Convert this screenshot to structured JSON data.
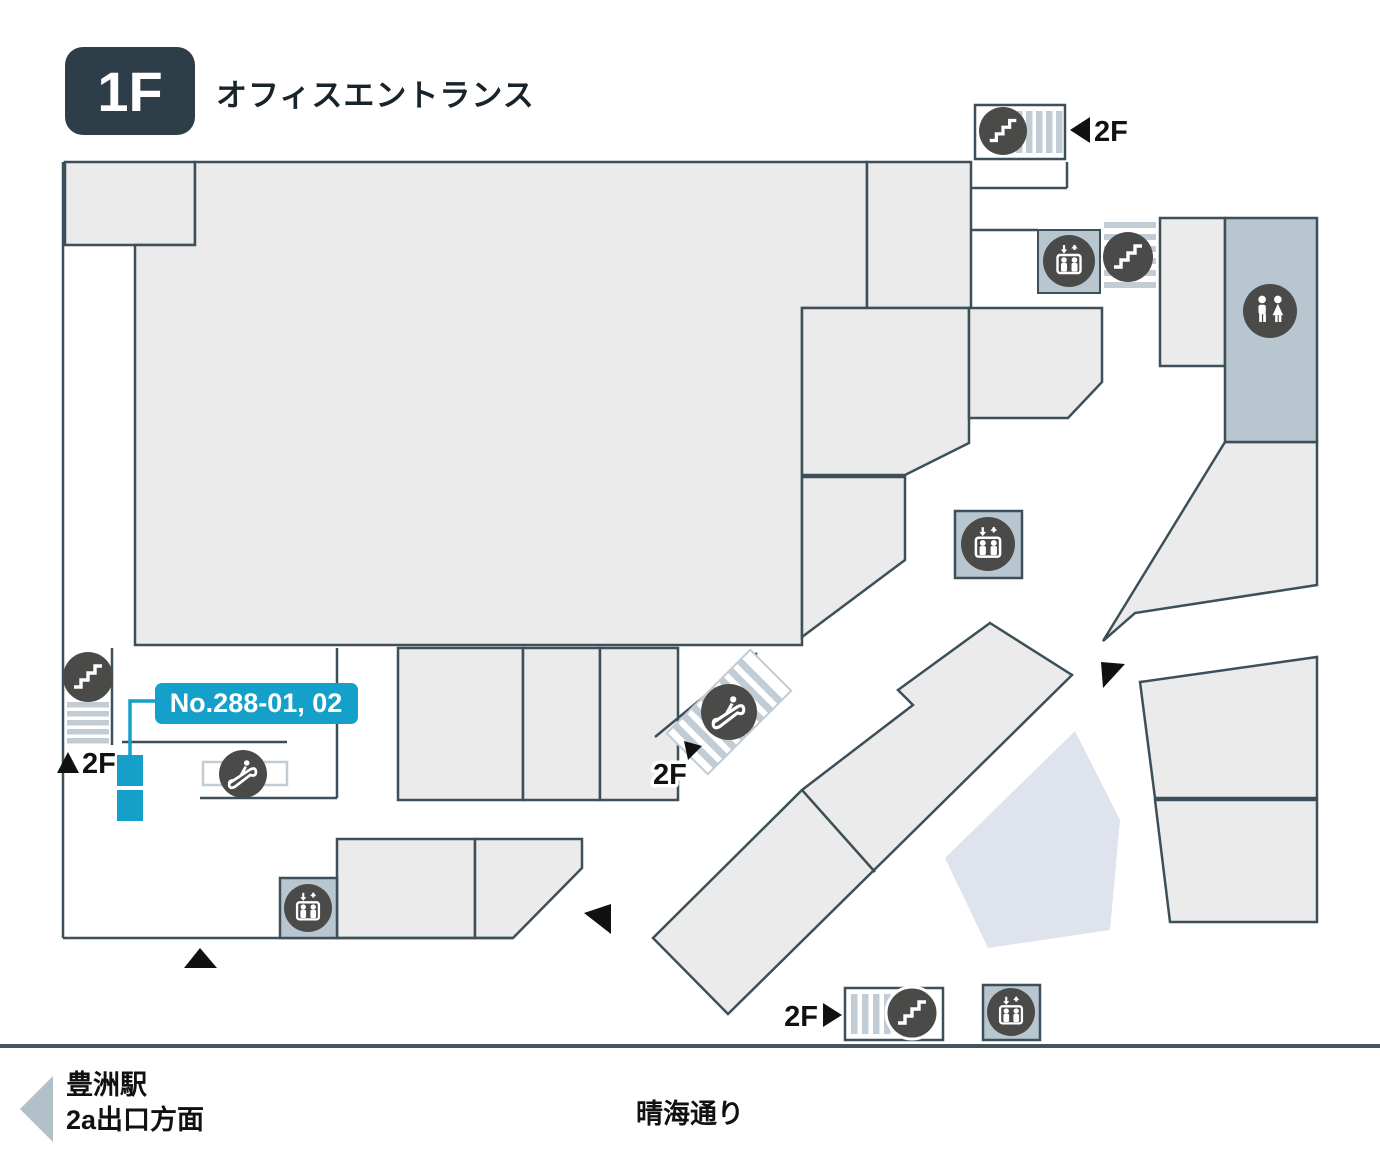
{
  "floor": {
    "badge": "1F",
    "title": "オフィスエントランス"
  },
  "unit_label": {
    "text": "No.288-01, 02"
  },
  "levels": {
    "up": "2F"
  },
  "footer": {
    "station_line1": "豊洲駅",
    "station_line2": "2a出口方面",
    "street": "晴海通り"
  },
  "icons": {
    "stairs": "stairs-icon",
    "escalator": "escalator-icon",
    "elevator": "elevator-icon",
    "restroom": "restroom-icon",
    "direction_arrows": "arrow-triangle-icons"
  },
  "colors": {
    "accent_blue": "#14a0c9",
    "wall": "#3d4f59",
    "tenant_fill": "#ebebeb",
    "facility_fill": "#b8c6d0",
    "stripe": "#c2ccd4",
    "icon_circle": "#4a4b49",
    "lavender_fill": "#dfe3ed",
    "badge_bg": "#2d3e48",
    "footer_rule": "#44555f",
    "station_arrow": "#b2c0ca"
  }
}
